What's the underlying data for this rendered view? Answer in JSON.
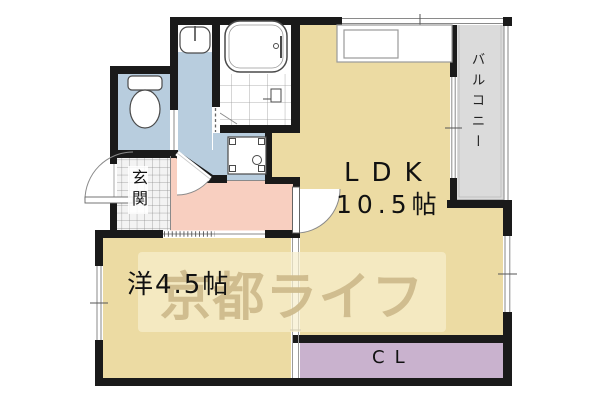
{
  "floor_plan": {
    "watermark": {
      "text": "京都ライフ",
      "band_color": "#f5eec9",
      "text_color": "#cfba8c"
    },
    "rooms": {
      "ldk": {
        "label": "LDK",
        "size": "10.5帖",
        "fill": "#ecdba3"
      },
      "western_room": {
        "label": "洋4.5帖",
        "fill": "#ecdba3"
      },
      "balcony": {
        "label": "バルコニー",
        "fill": "#dbdbdb"
      },
      "entrance": {
        "label": "玄関",
        "fill": "#f3f3f3"
      },
      "closet": {
        "label": "CL",
        "fill": "#c9b2ce"
      },
      "hallway": {
        "fill": "#f8cfc0"
      },
      "toilet_room": {
        "fill": "#b8cdde"
      },
      "washroom": {
        "fill": "#b8cdde"
      },
      "laundry_space": {
        "fill": "#b8cdde"
      },
      "bathroom": {
        "fill": "#ffffff"
      }
    },
    "fixtures": [
      "bathtub",
      "shower",
      "toilet",
      "washbasin",
      "washing-machine-pan",
      "kitchen-counter",
      "entrance-door",
      "hinged-doors",
      "sliding-doors",
      "windows"
    ],
    "colors": {
      "wall": "#1a1a1a",
      "fixture_outline": "#4a4a4a",
      "window_line": "#8a8a8a"
    }
  }
}
